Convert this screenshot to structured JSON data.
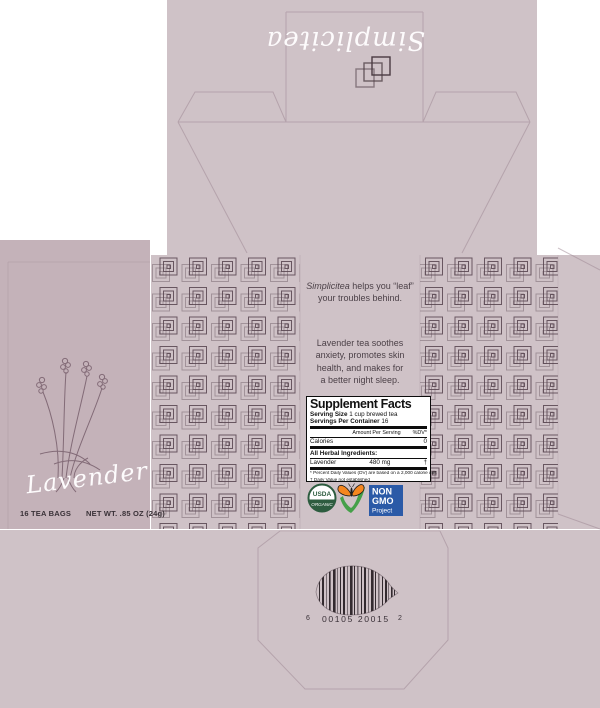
{
  "colors": {
    "mauve": "#cfc2c7",
    "mauve-panel": "#c4b2b9",
    "pattern-line": "#55434d",
    "dieline": "#9b8490",
    "ink": "#4c4148",
    "script-white": "#fdfbfc",
    "usda-green": "#2d5c3f",
    "nongmo-blue": "#2b5aa7",
    "butterfly-orange": "#f5861f",
    "check-green": "#45a049",
    "barcode-ink": "#332a2f"
  },
  "top_flap": {
    "logo_script": "Simplicitea"
  },
  "front_panel": {
    "flavor_script": "Lavender",
    "count_text": "16 TEA BAGS",
    "net_weight_text": "NET WT. .85 OZ (24g)"
  },
  "info_panel": {
    "tagline": {
      "brand": "Simplicitea",
      "line1_rest": " helps you “leaf”",
      "line2": "your troubles behind."
    },
    "description_lines": [
      "Lavender tea soothes",
      "anxiety, promotes skin",
      "health, and makes for",
      "a better night sleep."
    ]
  },
  "supplement_facts": {
    "title": "Supplement Facts",
    "serving_size_label": "Serving Size",
    "serving_size_value": " 1 cup brewed tea",
    "servings_label": "Servings Per Container",
    "servings_value": " 16",
    "amount_header": "Amount Per Serving",
    "dv_header": "%DV*",
    "calories_label": "Calories",
    "calories_value": "0",
    "section_header": "All Herbal Ingredients:",
    "ingredient_name": "Lavender",
    "ingredient_amount": "480 mg",
    "ingredient_dv": "†",
    "footnote_1": "* Percent Daily Values (DV) are based on a 2,000 calorie diet",
    "footnote_2": "† Daily Value not established"
  },
  "badges": {
    "usda_line1": "USDA",
    "usda_line2": "ORGANIC",
    "nongmo_line1": "NON",
    "nongmo_line2": "GMO",
    "nongmo_line3": "Project"
  },
  "barcode": {
    "prefix": "6",
    "digits": "00105 20015",
    "check": "2"
  }
}
